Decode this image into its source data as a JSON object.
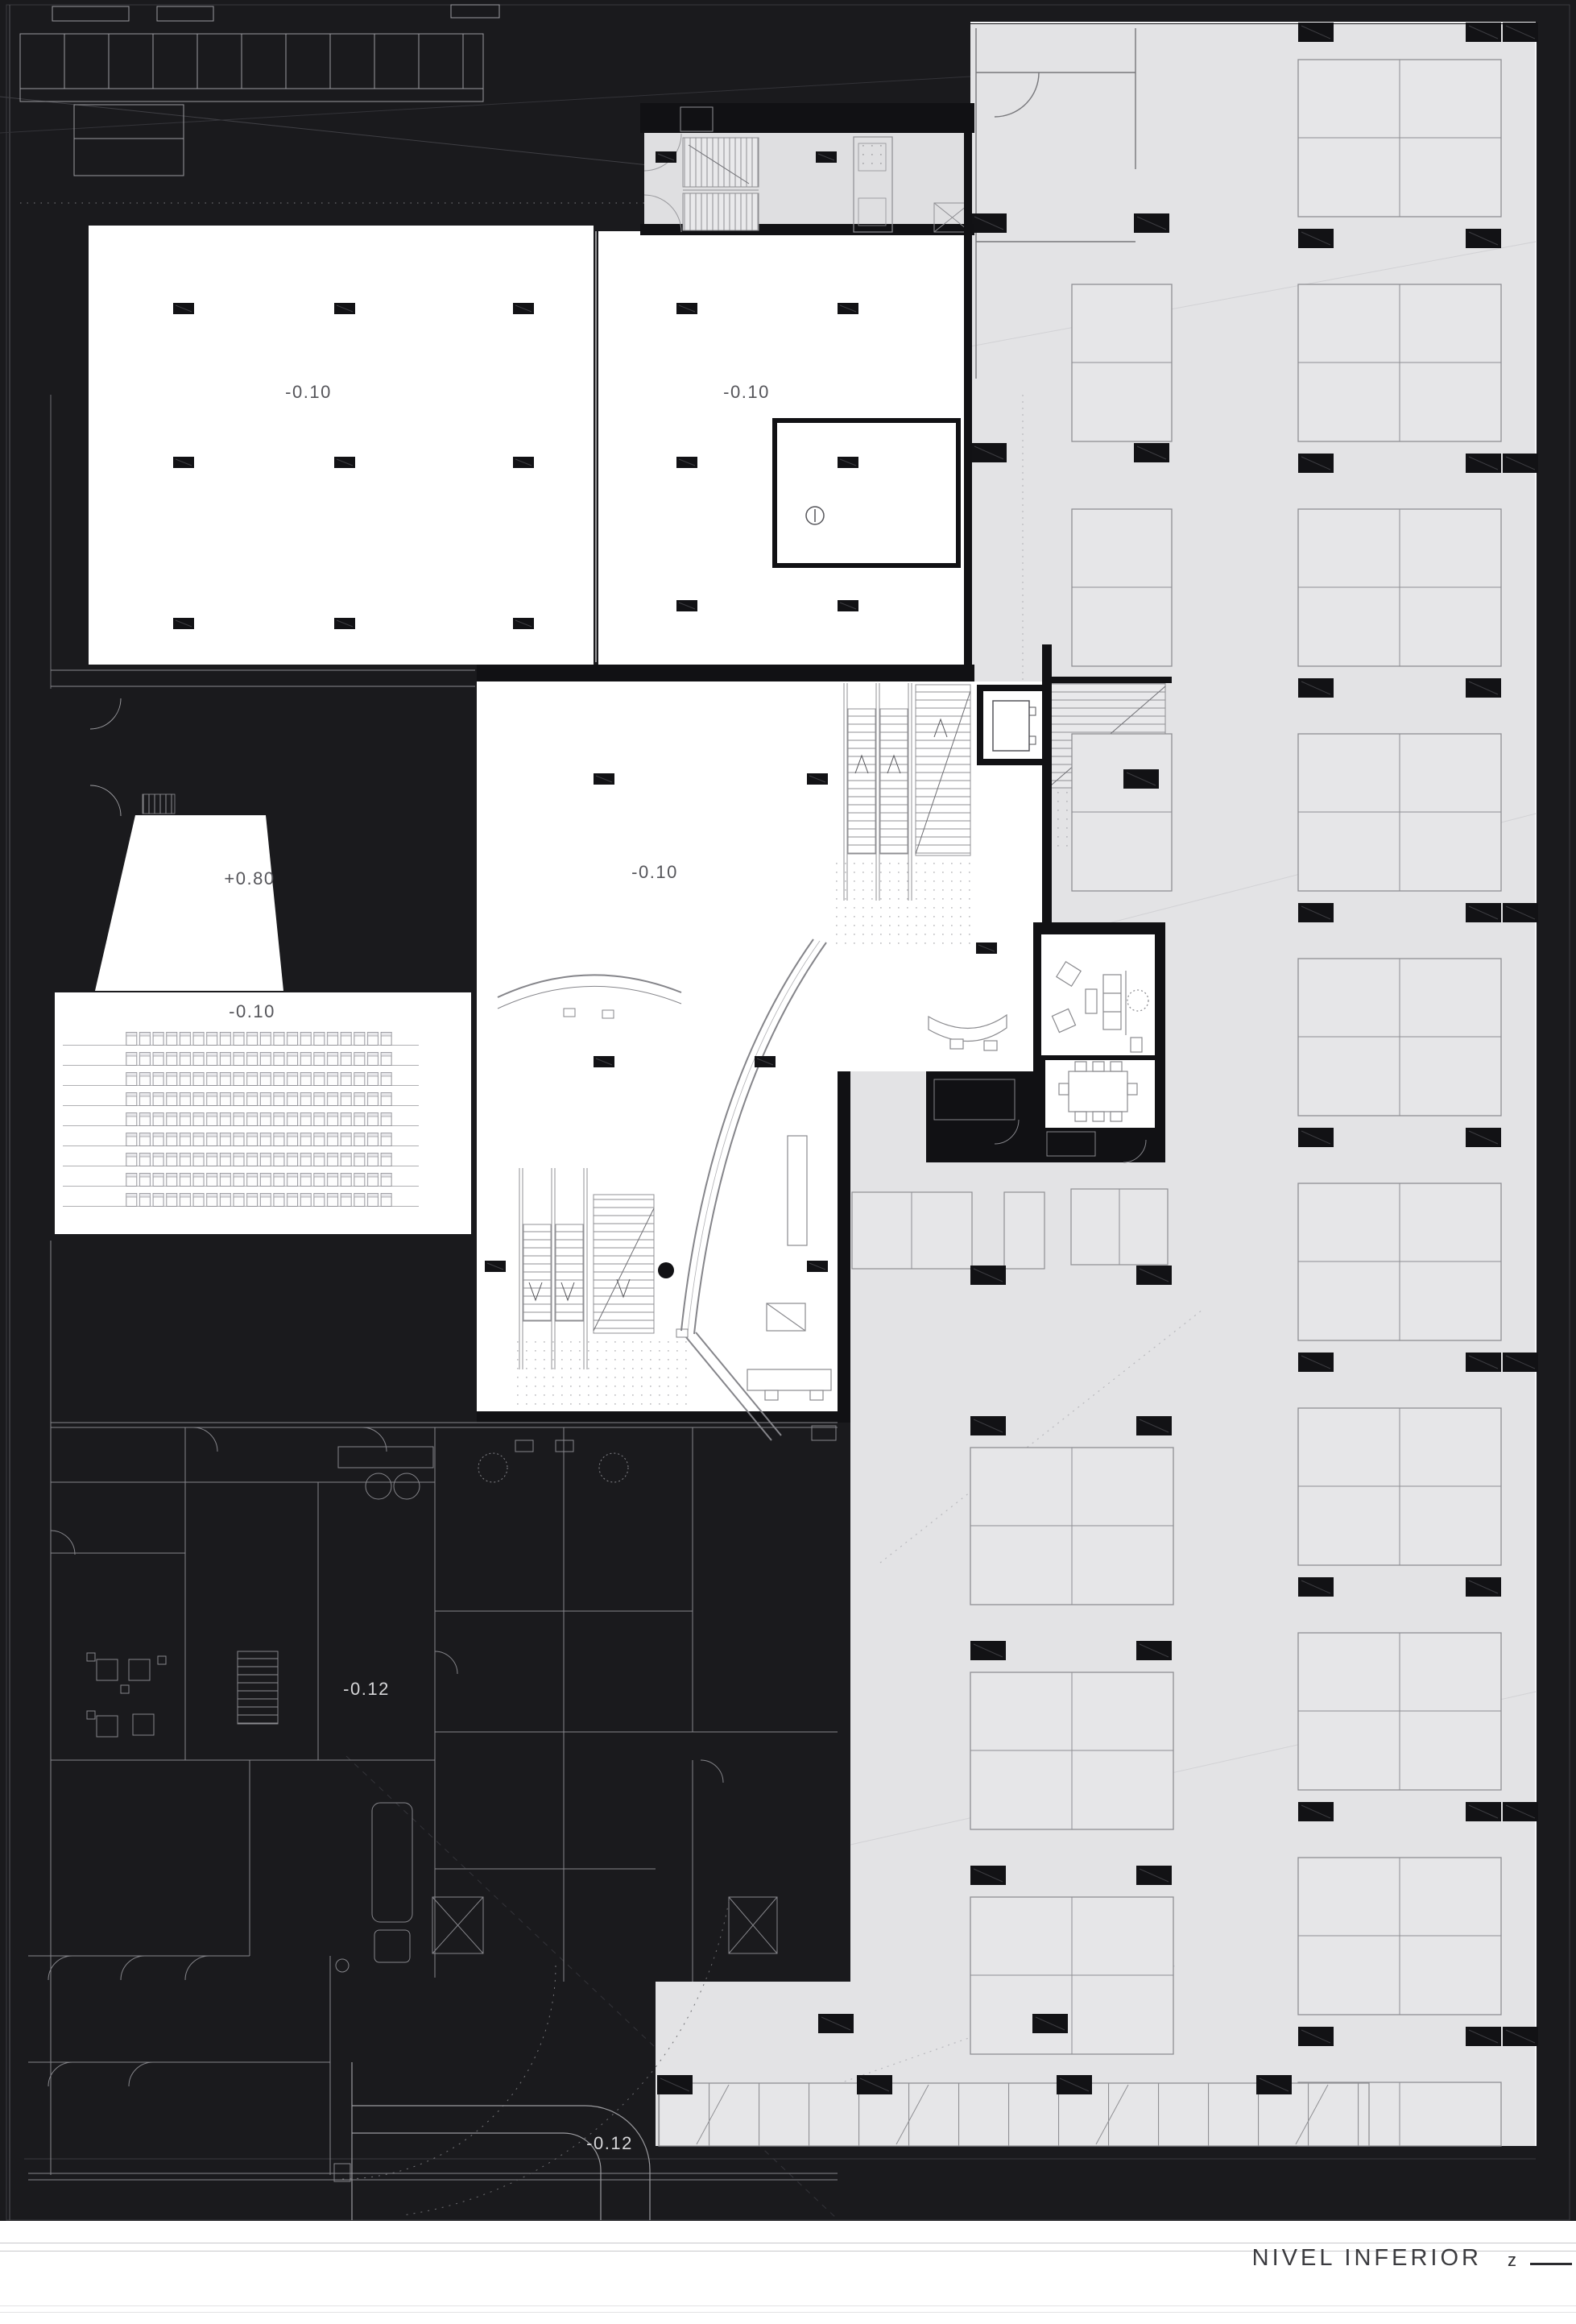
{
  "sheet": {
    "title": "NIVEL INFERIOR",
    "north_label": "z"
  },
  "levels": {
    "hall_west": "-0.10",
    "hall_east": "-0.10",
    "foyer": "-0.10",
    "stage": "+0.80",
    "auditorium": "-0.10",
    "services": "-0.12",
    "ramp": "-0.12"
  },
  "colors": {
    "paper": "#ffffff",
    "poche": "#1a1a1d",
    "parking_floor": "#e3e3e5",
    "stall_line": "#8f8f93",
    "label_dark": "#55555a",
    "label_light": "#d6d6d8"
  }
}
